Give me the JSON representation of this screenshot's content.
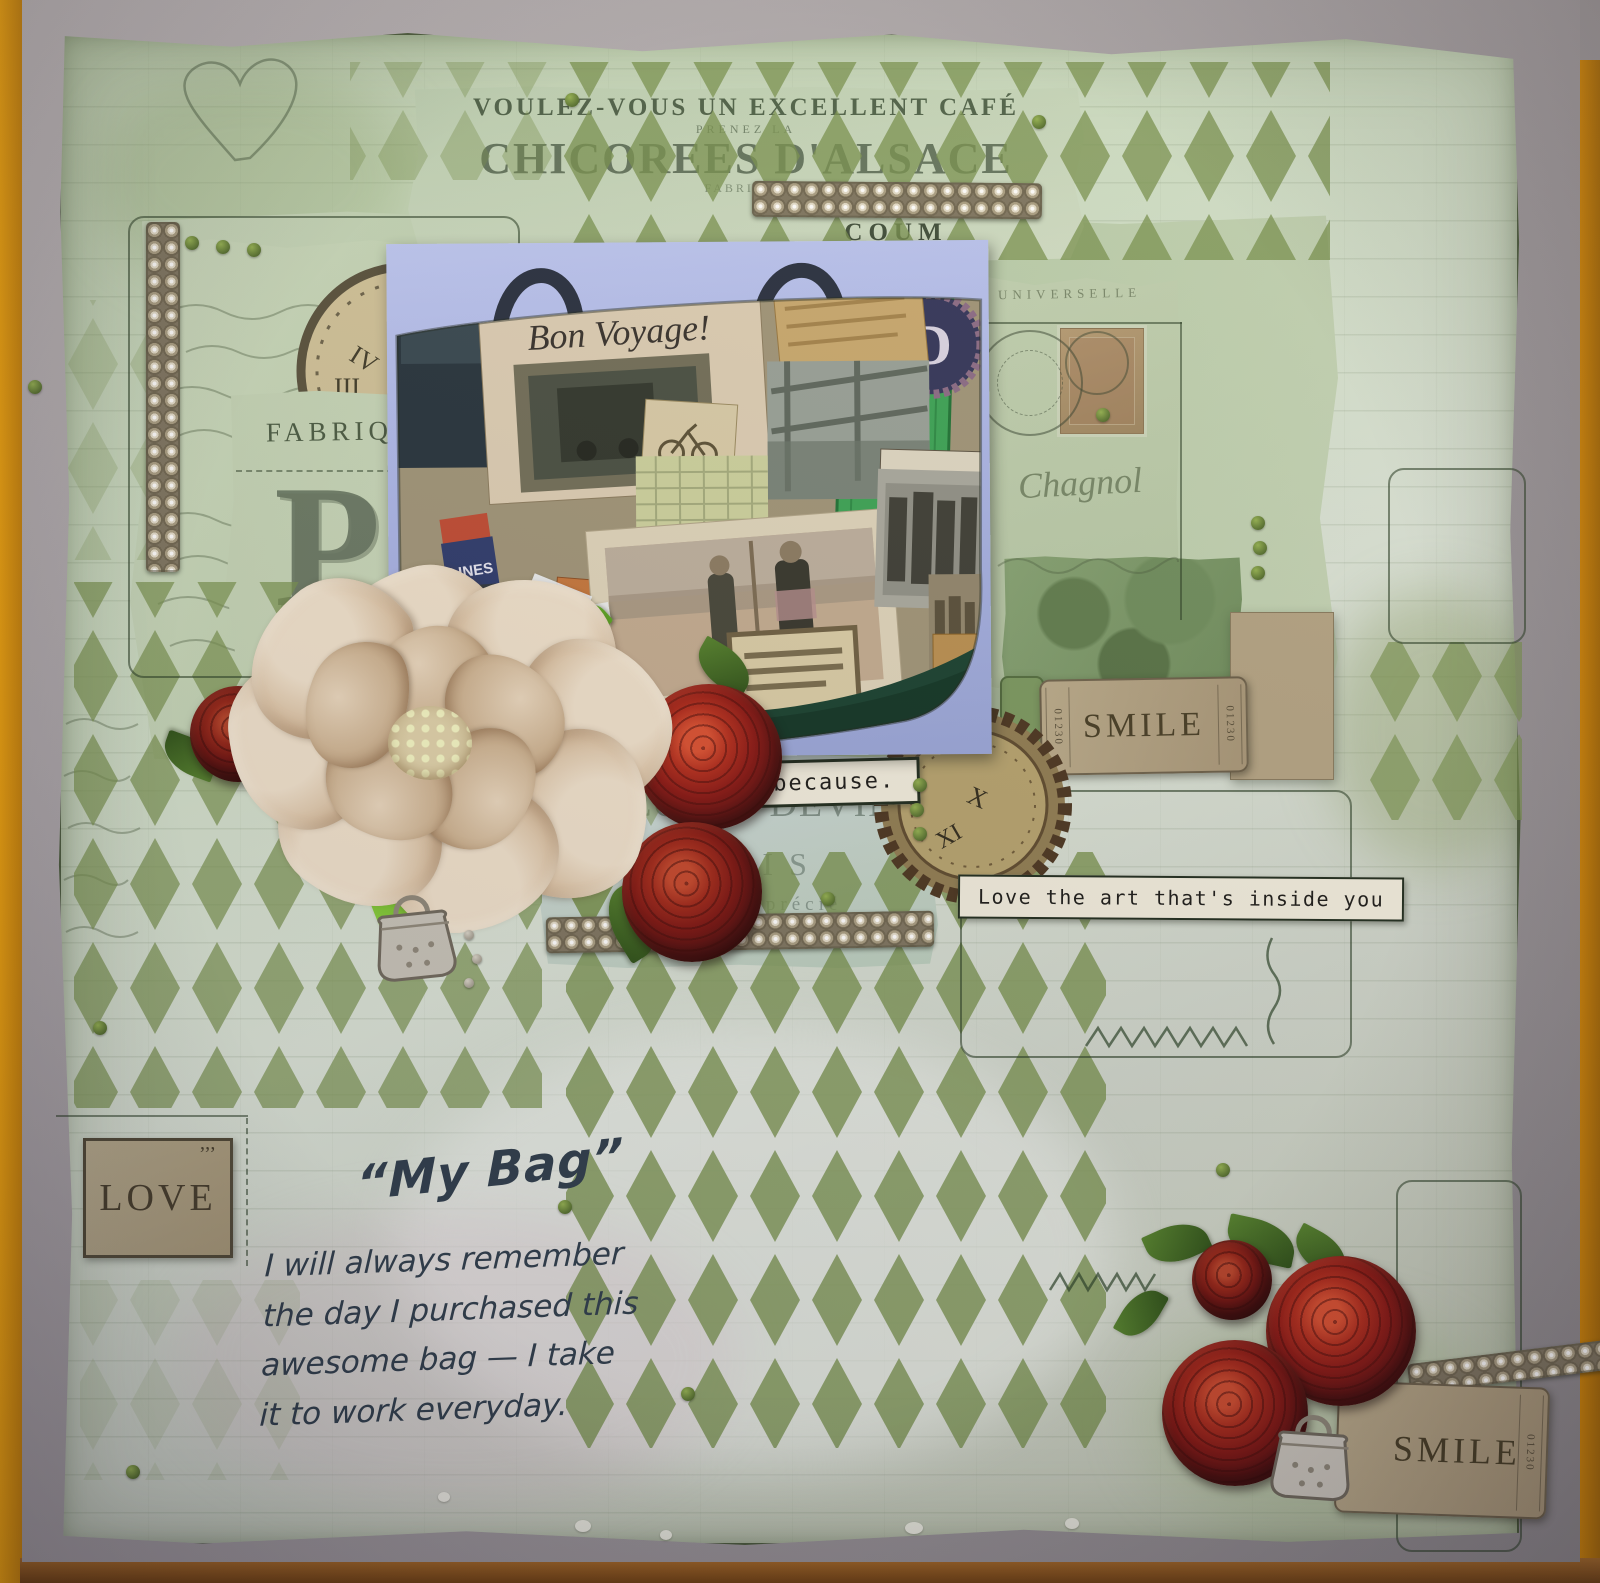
{
  "ad": {
    "line1": "VOULEZ-VOUS UN EXCELLENT CAFÉ",
    "line2": "PRENEZ LA",
    "title": "CHICOREES D'ALSACE",
    "sub1": "FABRIQUE",
    "sub2": "SER-COUME",
    "sub3": "COUM"
  },
  "bag": {
    "bon_voyage": "Bon Voyage!",
    "lines_label": "LINES",
    "to_paris": "TO PARIS",
    "car": "CAR",
    "car_no": "4",
    "badge_letter": "D"
  },
  "left": {
    "fabrique": "FABRIQUE",
    "monogram": "P"
  },
  "postcard": {
    "header": "UNIVERSELLE",
    "script": "Chagnol"
  },
  "clock_left": {
    "n1": "IV",
    "n2": "III",
    "n3": "II"
  },
  "clock_right": {
    "n1": "X",
    "n2": "XI"
  },
  "tickets": {
    "smile1": "SMILE",
    "smile1_no": "01230",
    "smile2": "SMILE",
    "smile2_no": "01230",
    "love": "LOVE",
    "love_marks": "’’’"
  },
  "labels": {
    "just_because": "Just because.",
    "love_art": "Love the art that's inside you"
  },
  "chocolat": {
    "line1": "CHOCOLAT DEVINCK",
    "line2": "PARIS",
    "line3": "Le Plus apprécié"
  },
  "journaling": {
    "title": "“My Bag”",
    "lines": [
      "I will always remember",
      "the day I purchased this",
      "awesome bag — I take",
      "it to work everyday."
    ]
  },
  "colors": {
    "page_green": "#c9d8c2",
    "diamond_olive": "#76904d",
    "kraft": "#b3a584",
    "rose_red": "#a61f1f",
    "photo_blue": "#aab6e8",
    "mat_grey": "#9b969a",
    "wood_orange": "#e8940a"
  }
}
